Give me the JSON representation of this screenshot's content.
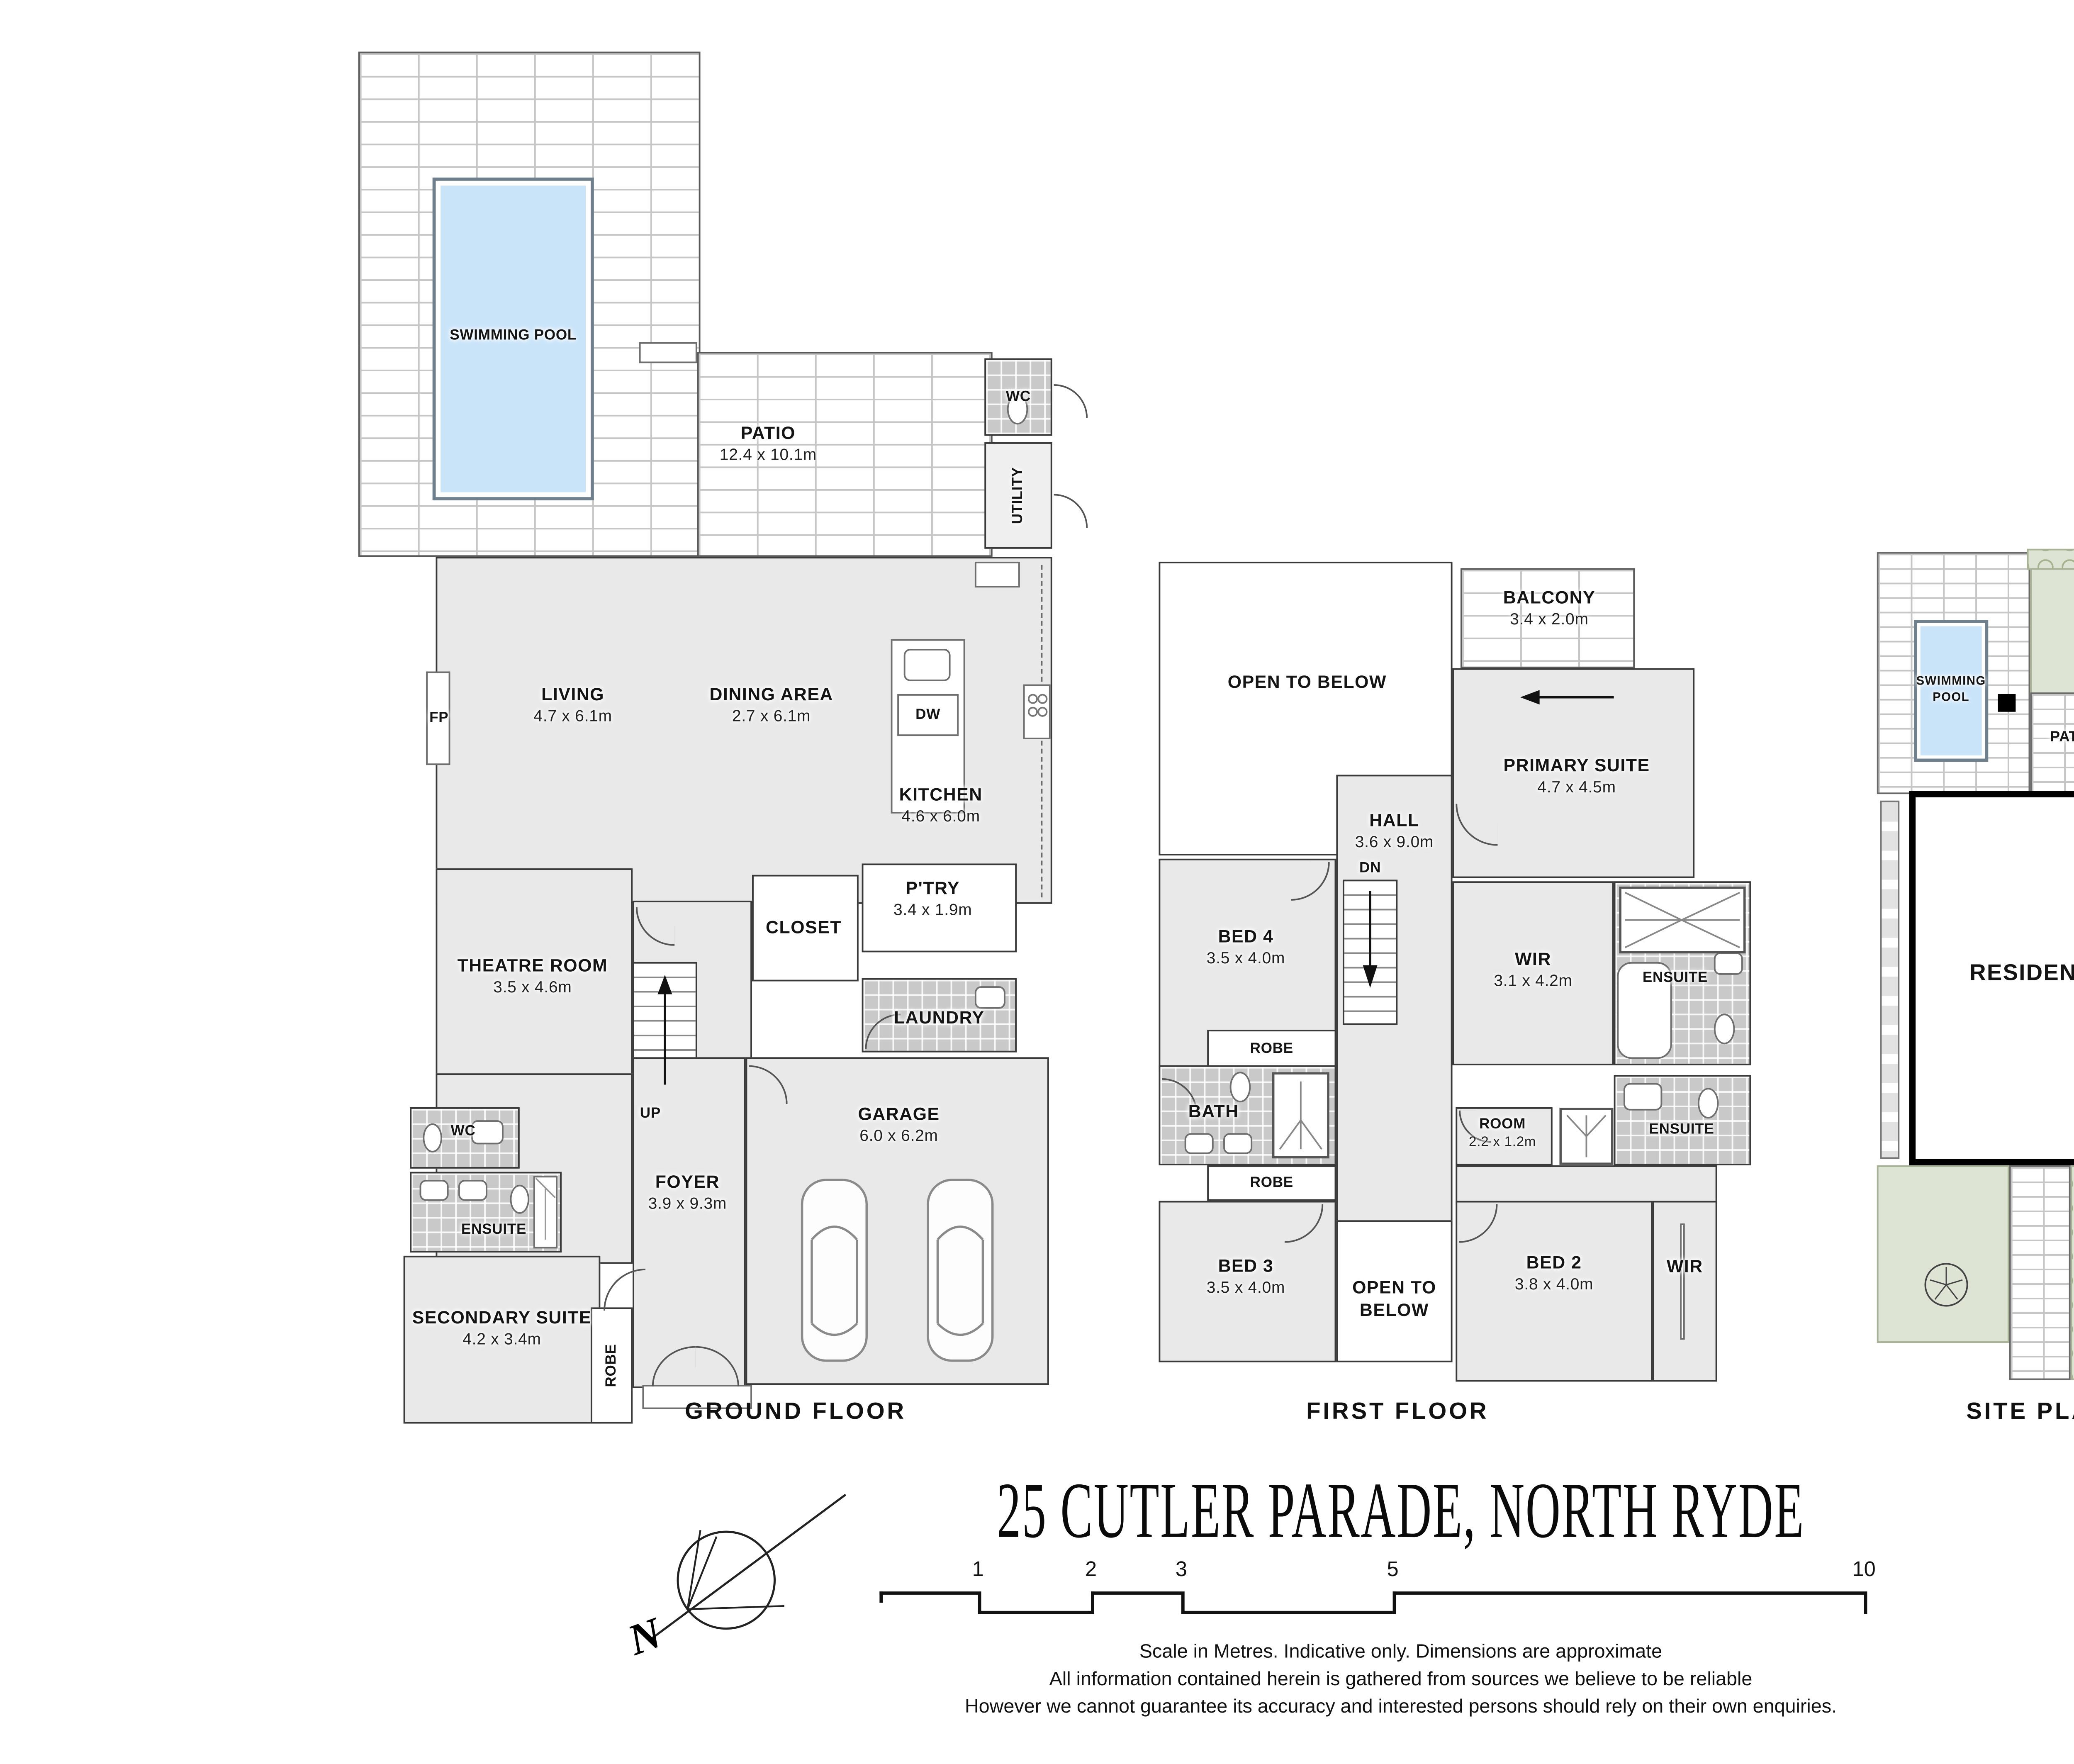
{
  "title": "25 CUTLER PARADE, NORTH RYDE",
  "ground_floor": {
    "label": "GROUND FLOOR",
    "rooms": {
      "swimming_pool": {
        "name": "SWIMMING POOL"
      },
      "patio": {
        "name": "PATIO",
        "dims": "12.4 x 10.1m"
      },
      "wc_upper": {
        "name": "WC"
      },
      "utility": {
        "name": "UTILITY"
      },
      "living": {
        "name": "LIVING",
        "dims": "4.7 x 6.1m"
      },
      "dining": {
        "name": "DINING AREA",
        "dims": "2.7 x 6.1m"
      },
      "kitchen": {
        "name": "KITCHEN",
        "dims": "4.6 x 6.0m"
      },
      "pantry": {
        "name": "P'TRY",
        "dims": "3.4 x 1.9m"
      },
      "closet": {
        "name": "CLOSET"
      },
      "theatre": {
        "name": "THEATRE ROOM",
        "dims": "3.5 x 4.6m"
      },
      "laundry": {
        "name": "LAUNDRY"
      },
      "garage": {
        "name": "GARAGE",
        "dims": "6.0 x 6.2m"
      },
      "foyer": {
        "name": "FOYER",
        "dims": "3.9 x 9.3m"
      },
      "wc_lower": {
        "name": "WC"
      },
      "ensuite": {
        "name": "ENSUITE"
      },
      "secondary_suite": {
        "name": "SECONDARY SUITE",
        "dims": "4.2 x 3.4m"
      },
      "robe": {
        "name": "ROBE"
      }
    },
    "annotations": {
      "up": "UP",
      "fp": "FP",
      "dw": "DW"
    }
  },
  "first_floor": {
    "label": "FIRST FLOOR",
    "rooms": {
      "open_to_below_top": {
        "name": "OPEN TO BELOW"
      },
      "balcony": {
        "name": "BALCONY",
        "dims": "3.4 x 2.0m"
      },
      "primary_suite": {
        "name": "PRIMARY SUITE",
        "dims": "4.7 x 4.5m"
      },
      "hall": {
        "name": "HALL",
        "dims": "3.6 x 9.0m"
      },
      "bed4": {
        "name": "BED 4",
        "dims": "3.5 x 4.0m"
      },
      "wir_primary": {
        "name": "WIR",
        "dims": "3.1 x 4.2m"
      },
      "ensuite_primary": {
        "name": "ENSUITE"
      },
      "robe_top": {
        "name": "ROBE"
      },
      "bath": {
        "name": "BATH"
      },
      "robe_bottom": {
        "name": "ROBE"
      },
      "room_small": {
        "name": "ROOM",
        "dims": "2.2 x 1.2m"
      },
      "ensuite_2": {
        "name": "ENSUITE"
      },
      "bed3": {
        "name": "BED 3",
        "dims": "3.5 x 4.0m"
      },
      "open_to_below_bottom": {
        "name": "OPEN TO BELOW"
      },
      "bed2": {
        "name": "BED 2",
        "dims": "3.8 x 4.0m"
      },
      "wir_bed2": {
        "name": "WIR"
      }
    },
    "annotations": {
      "dn": "DN"
    }
  },
  "site_plan": {
    "label": "SITE PLAN",
    "items": {
      "swimming_pool": {
        "name": "SWIMMING POOL"
      },
      "patio": {
        "name": "PATIO"
      },
      "residence": {
        "name": "RESIDENCE"
      },
      "driveway": {
        "name": "DRIVEWAY"
      }
    }
  },
  "footer": {
    "compass_north": "N",
    "scale_ticks": [
      "1",
      "2",
      "3",
      "5",
      "10"
    ],
    "disclaimer": [
      "Scale in Metres. Indicative only. Dimensions are approximate",
      "All information contained herein is gathered from sources we believe to be reliable",
      "However we cannot guarantee its accuracy and interested persons should rely on their own enquiries."
    ]
  }
}
